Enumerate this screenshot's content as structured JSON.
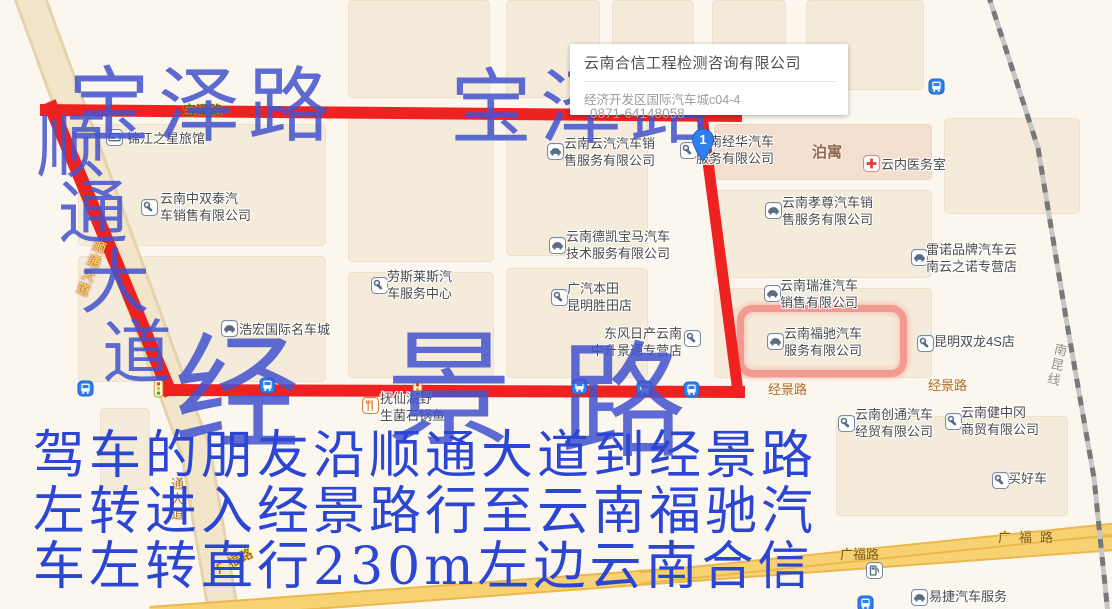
{
  "popup": {
    "title": "云南合信工程检测咨询有限公司",
    "address": "经济开发区国际汽车城c04-4",
    "phone": "0871-64148058"
  },
  "marker": {
    "number": "1"
  },
  "annotations": {
    "road_top_left": "宝泽路",
    "road_top_right": "宝泽路",
    "road_diagonal": "顺通大道",
    "road_main": "经景路",
    "directions_line1": "驾车的朋友沿顺通大道到经景路",
    "directions_line2": "左转进入经景路行至云南福驰汽",
    "directions_line3": "车左转直行230m左边云南合信"
  },
  "map": {
    "colors": {
      "route_red": "#ee1111",
      "highlight_red": "rgba(240,40,40,0.42)",
      "annotation_blue": "#4454ce",
      "directions_blue": "#2b46d2",
      "road_yellow": "#f8d272"
    },
    "highlighted_poi": "云南福驰汽车服务有限公司",
    "building_labels": [
      {
        "text": "泊寓",
        "x": 812,
        "y": 141
      }
    ],
    "railway_label": {
      "text": "南昆线",
      "x": 1052,
      "y": 341,
      "rotate": 13
    },
    "road_labels": [
      {
        "text": "宝泽路",
        "x": 183,
        "y": 100,
        "style": "onroute"
      },
      {
        "text": "经景路",
        "x": 768,
        "y": 379,
        "style": "orange"
      },
      {
        "text": "经景路",
        "x": 928,
        "y": 375,
        "style": "orange"
      },
      {
        "text": "广福路",
        "x": 998,
        "y": 527,
        "style": "brown",
        "ls": 8
      },
      {
        "text": "广福路",
        "x": 840,
        "y": 544,
        "style": "brown"
      },
      {
        "text": "广福路",
        "x": 212,
        "y": 560,
        "style": "brown",
        "rotate": -26
      },
      {
        "text": "顺通大道",
        "x": 92,
        "y": 237,
        "style": "goldvert",
        "rotate": 21
      },
      {
        "text": "通大道",
        "x": 167,
        "y": 477,
        "style": "orangevert"
      }
    ],
    "pois": [
      {
        "type": "hotel",
        "ix": 106,
        "iy": 129,
        "lx": 127,
        "ly": 130,
        "lines": [
          "锦江之星旅馆"
        ]
      },
      {
        "type": "wrench",
        "ix": 141,
        "iy": 199,
        "lx": 160,
        "ly": 190,
        "lines": [
          "云南中双泰汽",
          "车销售有限公司"
        ]
      },
      {
        "type": "car",
        "ix": 547,
        "iy": 143,
        "lx": 564,
        "ly": 135,
        "lines": [
          "云南云汽汽车销",
          "售服务有限公司"
        ]
      },
      {
        "type": "wrench",
        "ix": 680,
        "iy": 142,
        "lx": 696,
        "ly": 133,
        "lines": [
          "云南经华汽车",
          "服务有限公司"
        ]
      },
      {
        "type": "car",
        "ix": 549,
        "iy": 237,
        "lx": 566,
        "ly": 228,
        "lines": [
          "云南德凯宝马汽车",
          "技术服务有限公司"
        ]
      },
      {
        "type": "wrench",
        "ix": 371,
        "iy": 277,
        "lx": 387,
        "ly": 268,
        "lines": [
          "劳斯莱斯汽",
          "车服务中心"
        ]
      },
      {
        "type": "wrench",
        "ix": 551,
        "iy": 289,
        "lx": 567,
        "ly": 280,
        "lines": [
          "广汽本田",
          "昆明胜田店"
        ]
      },
      {
        "type": "car",
        "ix": 221,
        "iy": 320,
        "lx": 239,
        "ly": 321,
        "lines": [
          "浩宏国际名车城"
        ]
      },
      {
        "type": "restaurant",
        "ix": 362,
        "iy": 397,
        "lx": 380,
        "ly": 390,
        "lines": [
          "抚仙湖野",
          "生菌石锅鱼"
        ]
      },
      {
        "type": "wrench",
        "ix": 684,
        "iy": 330,
        "lx": 682,
        "ly": 325,
        "align": "right",
        "lines": [
          "东风日产云南",
          "中升景通专营店"
        ]
      },
      {
        "type": "car",
        "ix": 765,
        "iy": 202,
        "lx": 782,
        "ly": 194,
        "lines": [
          "云南孝尊汽车销",
          "售服务有限公司"
        ]
      },
      {
        "type": "car",
        "ix": 911,
        "iy": 249,
        "lx": 926,
        "ly": 241,
        "lines": [
          "雷诺品牌汽车云",
          "南云之诺专营店"
        ]
      },
      {
        "type": "car",
        "ix": 764,
        "iy": 285,
        "lx": 780,
        "ly": 277,
        "lines": [
          "云南瑞淮汽车",
          "销售有限公司"
        ]
      },
      {
        "type": "car",
        "ix": 767,
        "iy": 333,
        "lx": 784,
        "ly": 325,
        "lines": [
          "云南福驰汽车",
          "服务有限公司"
        ]
      },
      {
        "type": "wrench",
        "ix": 917,
        "iy": 335,
        "lx": 934,
        "ly": 333,
        "lines": [
          "昆明双龙4S店"
        ]
      },
      {
        "type": "hospital",
        "ix": 863,
        "iy": 155,
        "lx": 881,
        "ly": 156,
        "lines": [
          "云内医务室"
        ]
      },
      {
        "type": "wrench",
        "ix": 838,
        "iy": 415,
        "lx": 855,
        "ly": 406,
        "lines": [
          "云南创通汽车",
          "经贸有限公司"
        ]
      },
      {
        "type": "wrench",
        "ix": 945,
        "iy": 413,
        "lx": 961,
        "ly": 404,
        "lines": [
          "云南健中冈",
          "商贸有限公司"
        ]
      },
      {
        "type": "wrench",
        "ix": 992,
        "iy": 472,
        "lx": 1008,
        "ly": 470,
        "lines": [
          "买好车"
        ]
      },
      {
        "type": "car",
        "ix": 911,
        "iy": 589,
        "lx": 929,
        "ly": 588,
        "lines": [
          "易捷汽车服务"
        ]
      },
      {
        "type": "gas",
        "ix": 866,
        "iy": 562,
        "lines": []
      }
    ],
    "bus_stops": [
      {
        "x": 77,
        "y": 380
      },
      {
        "x": 259,
        "y": 377
      },
      {
        "x": 571,
        "y": 378
      },
      {
        "x": 636,
        "y": 380
      },
      {
        "x": 683,
        "y": 381
      },
      {
        "x": 928,
        "y": 78
      },
      {
        "x": 857,
        "y": 595
      }
    ],
    "traffic_lights": [
      {
        "x": 153,
        "y": 379
      },
      {
        "x": 412,
        "y": 380
      }
    ]
  }
}
